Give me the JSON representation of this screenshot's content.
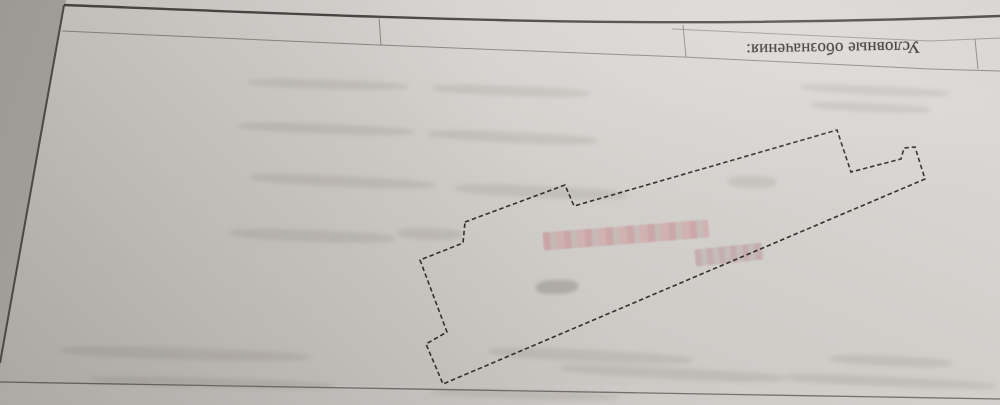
{
  "legend": {
    "label": "Условные обозначения:",
    "orientation": "upside-down"
  },
  "plan": {
    "parcel_polygon_points": "465,222 565,185 574,206 837,130 851,172 901,159 904,148 915,147 925,179 443,384 426,344 447,332 420,260 463,243",
    "boundary_line_style": "dashed"
  },
  "colors": {
    "paper": "#cfccc8",
    "paper_light": "#d9d7d4",
    "paper_shadow": "#c2bfbb",
    "outside_edge": "#b0ada9",
    "border_ink": "#3c3a37",
    "thin_line": "#7b7976",
    "parcel_ink": "#32302c",
    "redaction_pink": "#c6868b"
  }
}
